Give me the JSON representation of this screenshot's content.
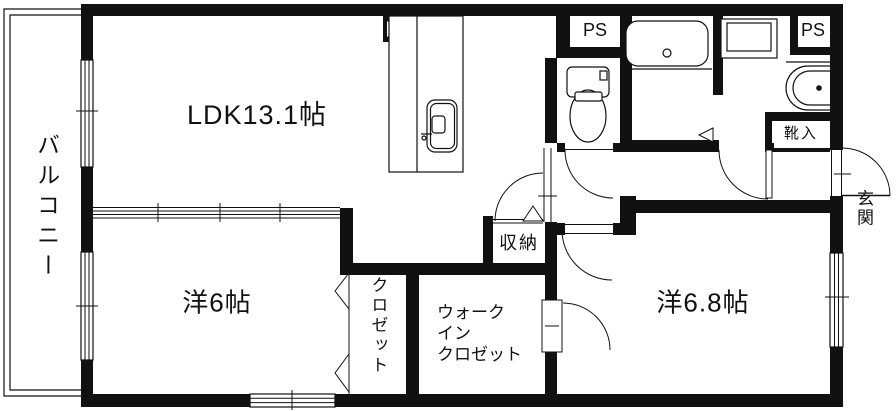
{
  "document": {
    "type": "apartment-floor-plan",
    "style": "black-and-white line drawing"
  },
  "rooms": {
    "balcony": {
      "label": "バルコニー"
    },
    "ldk": {
      "label": "LDK13.1帖",
      "name": "LDK",
      "size_display": "13.1帖"
    },
    "bedroom_west": {
      "label": "洋6帖",
      "name": "洋室",
      "size_display": "6帖"
    },
    "bedroom_east": {
      "label": "洋6.8帖",
      "name": "洋室",
      "size_display": "6.8帖"
    },
    "closet": {
      "label": "クロゼット"
    },
    "walk_in_closet": {
      "label": "ウォーク\nイン\nクロゼット"
    },
    "storage": {
      "label": "収納"
    },
    "entrance": {
      "label": "玄関"
    },
    "shoe_cabinet": {
      "label": "靴入"
    },
    "pipe_space_left": {
      "label": "PS"
    },
    "pipe_space_right": {
      "label": "PS"
    }
  },
  "symbols": {
    "kitchen_sink": "kitchen counter with sink",
    "duct": "square with X (pipe shaft)",
    "bathtub": "rounded bathtub",
    "toilet": "toilet with tank",
    "washer_pan": "washing machine pan",
    "washbasin": "vanity basin",
    "sliding_partition": "3-track sliding partition between LDK and bedroom",
    "swing_doors": "quarter-circle door swings",
    "bifold_doors": "zigzag closet bifold doors",
    "windows": "double-line sliding windows"
  },
  "colors": {
    "line": "#111111",
    "background": "#ffffff"
  }
}
